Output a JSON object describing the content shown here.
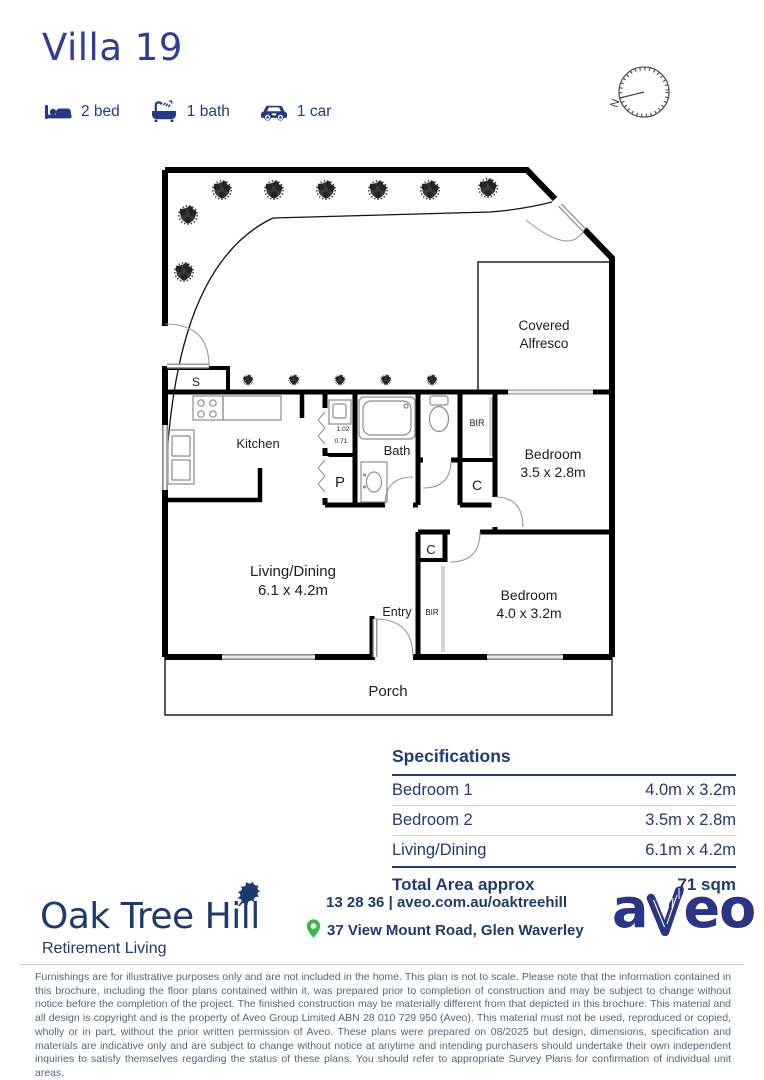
{
  "header": {
    "title": "Villa 19",
    "features": [
      {
        "icon": "bed-icon",
        "label": "2 bed"
      },
      {
        "icon": "bath-icon",
        "label": "1 bath"
      },
      {
        "icon": "car-icon",
        "label": "1 car"
      }
    ]
  },
  "compass": {
    "north_label": "N"
  },
  "floor_plan": {
    "labels": {
      "storage": "S",
      "kitchen": "Kitchen",
      "pantry": "P",
      "bath": "Bath",
      "bir_top": "BIR",
      "closet_hall": "C",
      "closet_entry": "C",
      "bir_entry": "BIR",
      "entry": "Entry",
      "living_name": "Living/Dining",
      "living_size": "6.1 x 4.2m",
      "bedroom2_name": "Bedroom",
      "bedroom2_size": "3.5 x 2.8m",
      "bedroom1_name": "Bedroom",
      "bedroom1_size": "4.0 x 3.2m",
      "alfresco_line1": "Covered",
      "alfresco_line2": "Alfresco",
      "porch": "Porch",
      "dim_width": "1.02",
      "dim_depth": "0.71"
    }
  },
  "specifications": {
    "heading": "Specifications",
    "rows": [
      {
        "name": "Bedroom 1",
        "value": "4.0m x 3.2m"
      },
      {
        "name": "Bedroom 2",
        "value": "3.5m x 2.8m"
      },
      {
        "name": "Living/Dining",
        "value": "6.1m x 4.2m"
      }
    ],
    "total": {
      "name": "Total Area approx",
      "value": "71 sqm"
    }
  },
  "footer": {
    "community_name": "Oak Tree Hill",
    "tagline": "Retirement Living",
    "phone": "13 28 36",
    "separator": "|",
    "website": "aveo.com.au/oaktreehill",
    "address": "37 View Mount Road, Glen Waverley",
    "brand_logo": {
      "full_name": "aveo",
      "before_leaf": "a",
      "after_leaf": "eo"
    }
  },
  "disclaimer": "Furnishings are for illustrative purposes only and are not included in the home. This plan is not to scale. Please note that the information contained in this brochure, including the floor plans contained within it, was prepared prior to completion of construction and may be subject to change without notice before the completion of the project. The finished construction may be materially different from that depicted in this brochure. This material and all design is copyright and is the property of Aveo Group Limited ABN 28 010 729 950 (Aveo). This material must not be used, reproduced or copied, wholly or in part, without the prior written permission of Aveo. These plans were prepared on 08/2025 but design, dimensions, specification and materials are indicative only and are subject to change without notice at anytime and intending purchasers should undertake their own independent inquiries to satisfy themselves regarding the status of these plans. You should refer to appropriate Survey Plans for confirmation of individual unit areas.",
  "colors": {
    "title_blue": "#2f3d96",
    "brand_navy": "#1d3a6e",
    "spec_navy": "#1e3c7b",
    "accent_green": "#3bb54a",
    "aveo_logo_blue": "#2a3585"
  }
}
